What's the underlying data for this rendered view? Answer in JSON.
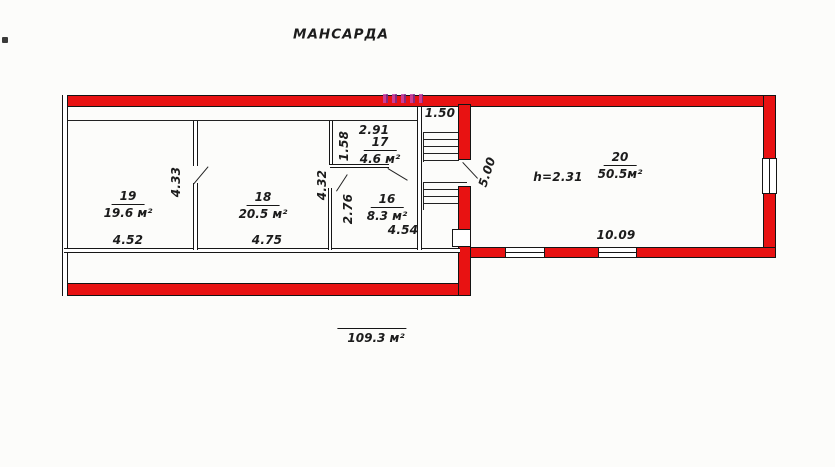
{
  "title": "МАНСАРДА",
  "total_area": "109.3 м²",
  "rooms": {
    "r19": {
      "number": "19",
      "area": "19.6 м²",
      "width": "4.52",
      "depth": "4.33"
    },
    "r18": {
      "number": "18",
      "area": "20.5 м²",
      "width": "4.75",
      "depth": "4.32"
    },
    "r17": {
      "number": "17",
      "area": "4.6 м²",
      "width": "2.91",
      "depth": "1.58"
    },
    "r16": {
      "number": "16",
      "area": "8.3 м²",
      "width": "4.54",
      "depth": "2.76"
    },
    "r20": {
      "number": "20",
      "area": "50.5м²",
      "width": "10.09",
      "depth": "5.00",
      "ceiling_height": "h=2.31"
    }
  },
  "stair": {
    "width": "1.50"
  },
  "colors": {
    "wall_red": "#e81212",
    "artifact_magenta": "#cc44aa"
  }
}
